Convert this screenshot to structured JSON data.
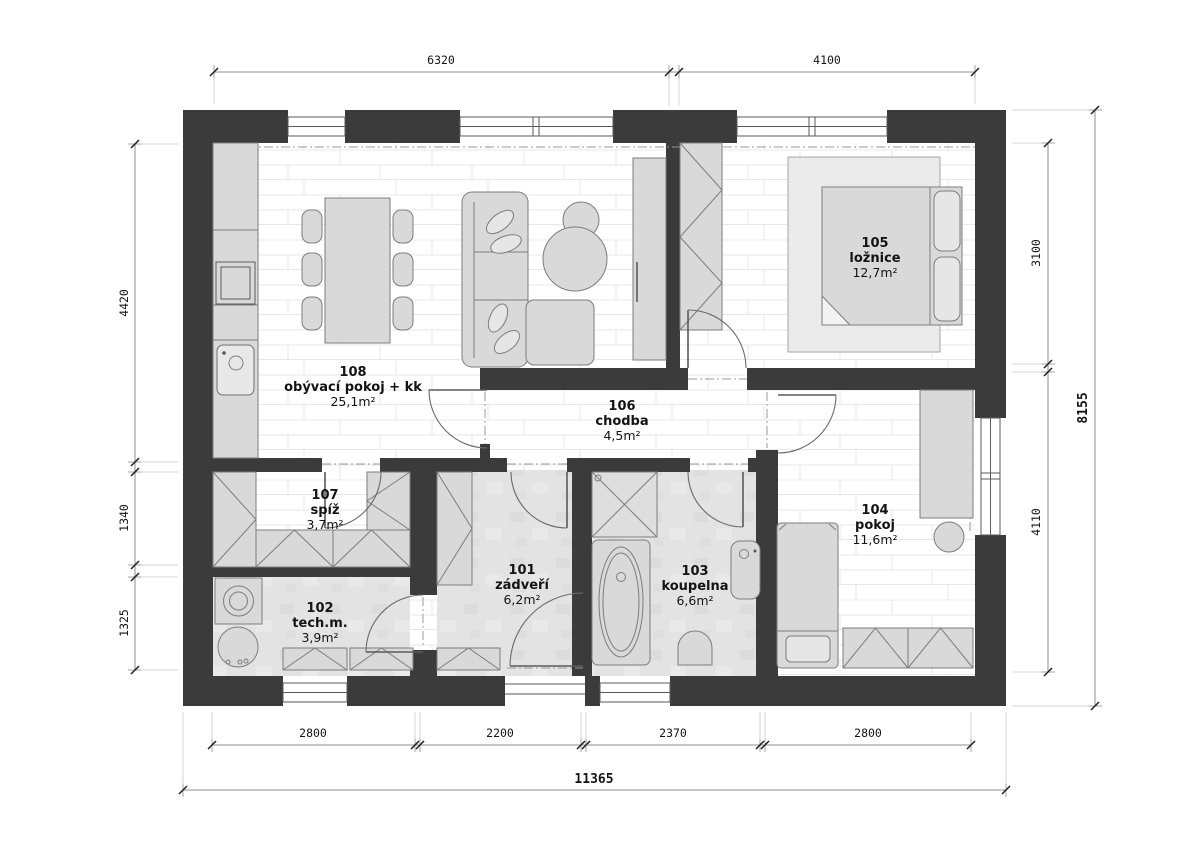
{
  "plan": {
    "rooms": [
      {
        "number": "101",
        "name": "zádveří",
        "area": "6,2m²"
      },
      {
        "number": "102",
        "name": "tech.m.",
        "area": "3,9m²"
      },
      {
        "number": "103",
        "name": "koupelna",
        "area": "6,6m²"
      },
      {
        "number": "104",
        "name": "pokoj",
        "area": "11,6m²"
      },
      {
        "number": "105",
        "name": "ložnice",
        "area": "12,7m²"
      },
      {
        "number": "106",
        "name": "chodba",
        "area": "4,5m²"
      },
      {
        "number": "107",
        "name": "spíž",
        "area": "3,7m²"
      },
      {
        "number": "108",
        "name": "obývací pokoj + kk",
        "area": "25,1m²"
      }
    ],
    "dimensions": {
      "top": [
        "6320",
        "4100"
      ],
      "left": [
        "4420",
        "1340",
        "1325"
      ],
      "right": [
        "3100",
        "4110"
      ],
      "right_total": "8155",
      "bottom": [
        "2800",
        "2200",
        "2370",
        "2800"
      ],
      "bottom_total": "11365"
    },
    "colors": {
      "wall": "#3b3b3b",
      "furniture": "#d9d9d9",
      "floor_gray": "#e2e2e2",
      "plank_line": "#e7e7e7"
    }
  }
}
